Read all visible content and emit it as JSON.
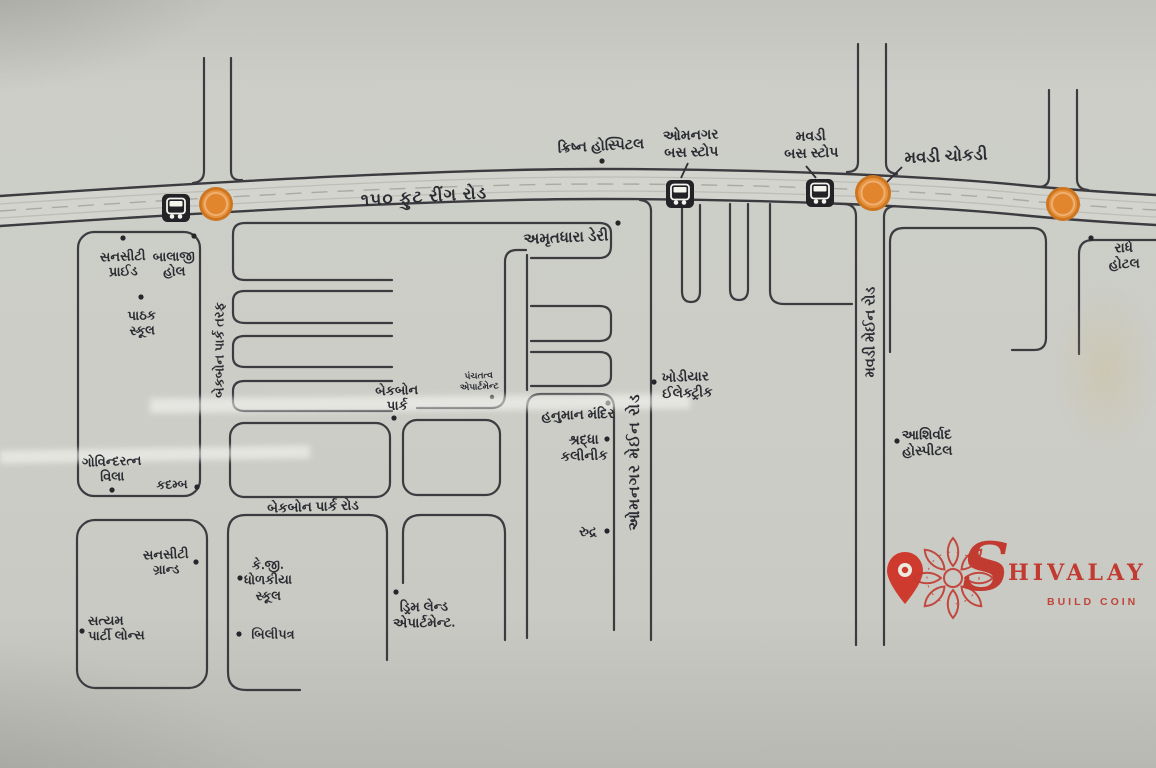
{
  "colors": {
    "paper": "#cbccc5",
    "road_line": "#3b3b40",
    "junction_orange": "#e8923c",
    "junction_ring": "#cd7622",
    "brand_red": "#c23b31"
  },
  "roads": {
    "ring_road": "૧૫૦ ફુટ રીંગ રોડ",
    "backbone_park_taraf": "બેકબોન પાર્ક તરફ",
    "backbone_park_road": "બેકબોન પાર્ક રોડ",
    "omnagar_main_road": "ઓમનગર મેઈન રોડ",
    "mavdi_main_road": "મવડી મેઈન રોડ"
  },
  "junction": {
    "mavdi_chokdi": "મવડી ચોકડી"
  },
  "bus_stops": {
    "omnagar": "ઓમનગર\nબસ સ્ટોપ",
    "mavdi": "મવડી\nબસ સ્ટોપ"
  },
  "places": {
    "krishna_hospital": "ક્રિષ્ન હોસ્પિટલ",
    "amrutdhara_dairy": "અમૃતધારા ડેરી",
    "suncity_pride": "સનસીટી\nપ્રાઈડ",
    "balaji_hall": "બાલાજી\nહોલ",
    "pathak_school": "પાઠક\nસ્કૂલ",
    "govindratna_villa": "ગોવિન્દરત્ન\nવિલા",
    "kadamb": "કદમ્બ",
    "suncity_grand": "સનસીટી\nગ્રાન્ડ",
    "satyam_party_lawns": "સત્યમ\nપાર્ટી લોન્સ",
    "kg_dholakiya_school": "કે.જી.\nધોળકીયા\nસ્કૂલ",
    "bilipatra": "બિલીપત્ર",
    "backbone_park": "બેકબોન\nપાર્ક",
    "panchtatva_apartment": "પંચતત્વ\nએપાર્ટમેન્ટ",
    "hanuman_mandir": "હનુમાન મંદિર",
    "shraddha_clinic": "શ્રદ્ધા\nકલીનીક",
    "rudra": "રુદ્ર",
    "khodiyar_electric": "ખોડીયાર\nઈલેક્ટ્રીક",
    "dream_land_apartment": "ડ્રિમ લેન્ડ\nએપાર્ટમેન્ટ.",
    "ashirwad_hospital": "આશિર્વાદ\nહોસ્પીટલ",
    "radhe_hotel": "રાધે હોટલ"
  },
  "logo": {
    "initial": "S",
    "name_rest": "HIVALAY",
    "tagline": "BUILD COIN"
  }
}
